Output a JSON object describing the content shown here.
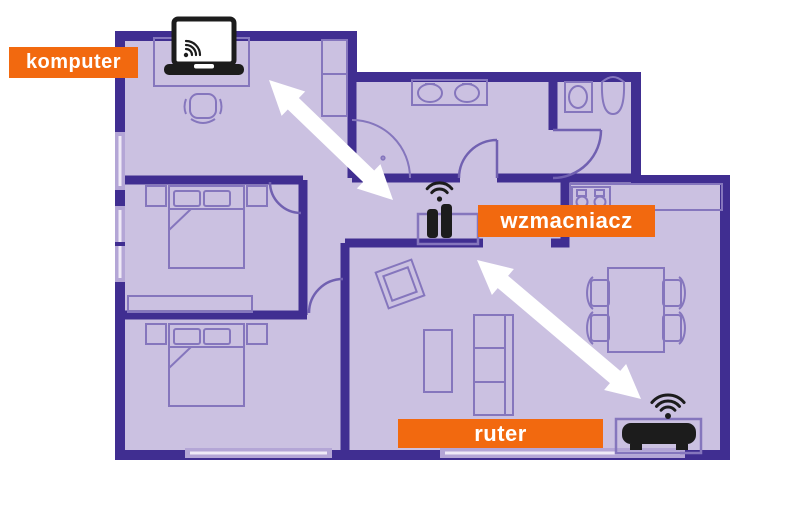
{
  "labels": {
    "computer": "komputer",
    "repeater": "wzmacniacz",
    "router": "ruter"
  },
  "icons": {
    "computer": "laptop-wifi-icon",
    "repeater": "wifi-repeater-icon",
    "router": "wifi-router-icon"
  },
  "colors": {
    "accent_orange": "#f2690f",
    "wall_purple": "#402e91",
    "floor_lavender": "#cbc1e1",
    "furniture_line": "#8576bd",
    "window_glass": "#b4a6d6",
    "arrow_white": "#ffffff",
    "device_black": "#1c1c1c",
    "label_text": "#ffffff"
  },
  "connections": [
    {
      "from": "komputer",
      "to": "wzmacniacz"
    },
    {
      "from": "wzmacniacz",
      "to": "ruter"
    }
  ]
}
